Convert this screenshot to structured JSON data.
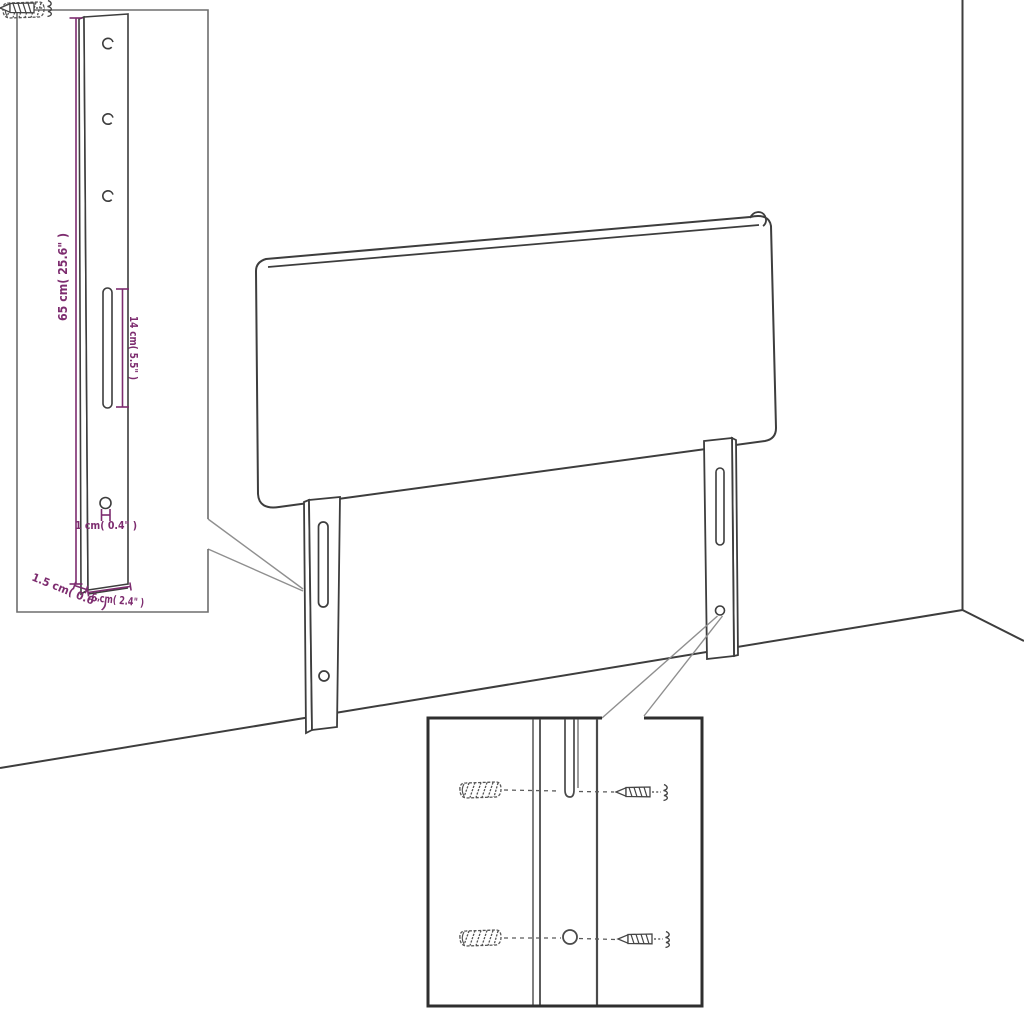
{
  "diagram": {
    "kind": "product-assembly-diagram",
    "colors": {
      "outline": "#3d3d3d",
      "inset_border_light": "#6e6e6e",
      "inset_border_dark": "#2f2f2f",
      "leader_line": "#8f8f8f",
      "dimension_text": "#7d2c6f"
    },
    "leg_detail_inset": {
      "hole_count": 3,
      "dimensions": {
        "leg_height": "65 cm( 25.6\" )",
        "slot_length": "14 cm( 5.5\" )",
        "hole_diameter": "1 cm( 0.4\" )",
        "leg_thickness": "1.5 cm( 0.6\" )",
        "leg_width": "6 cm( 2.4\" )"
      }
    },
    "mounting_detail_inset": {
      "wall_plug_count": 2,
      "screw_count": 2
    }
  }
}
